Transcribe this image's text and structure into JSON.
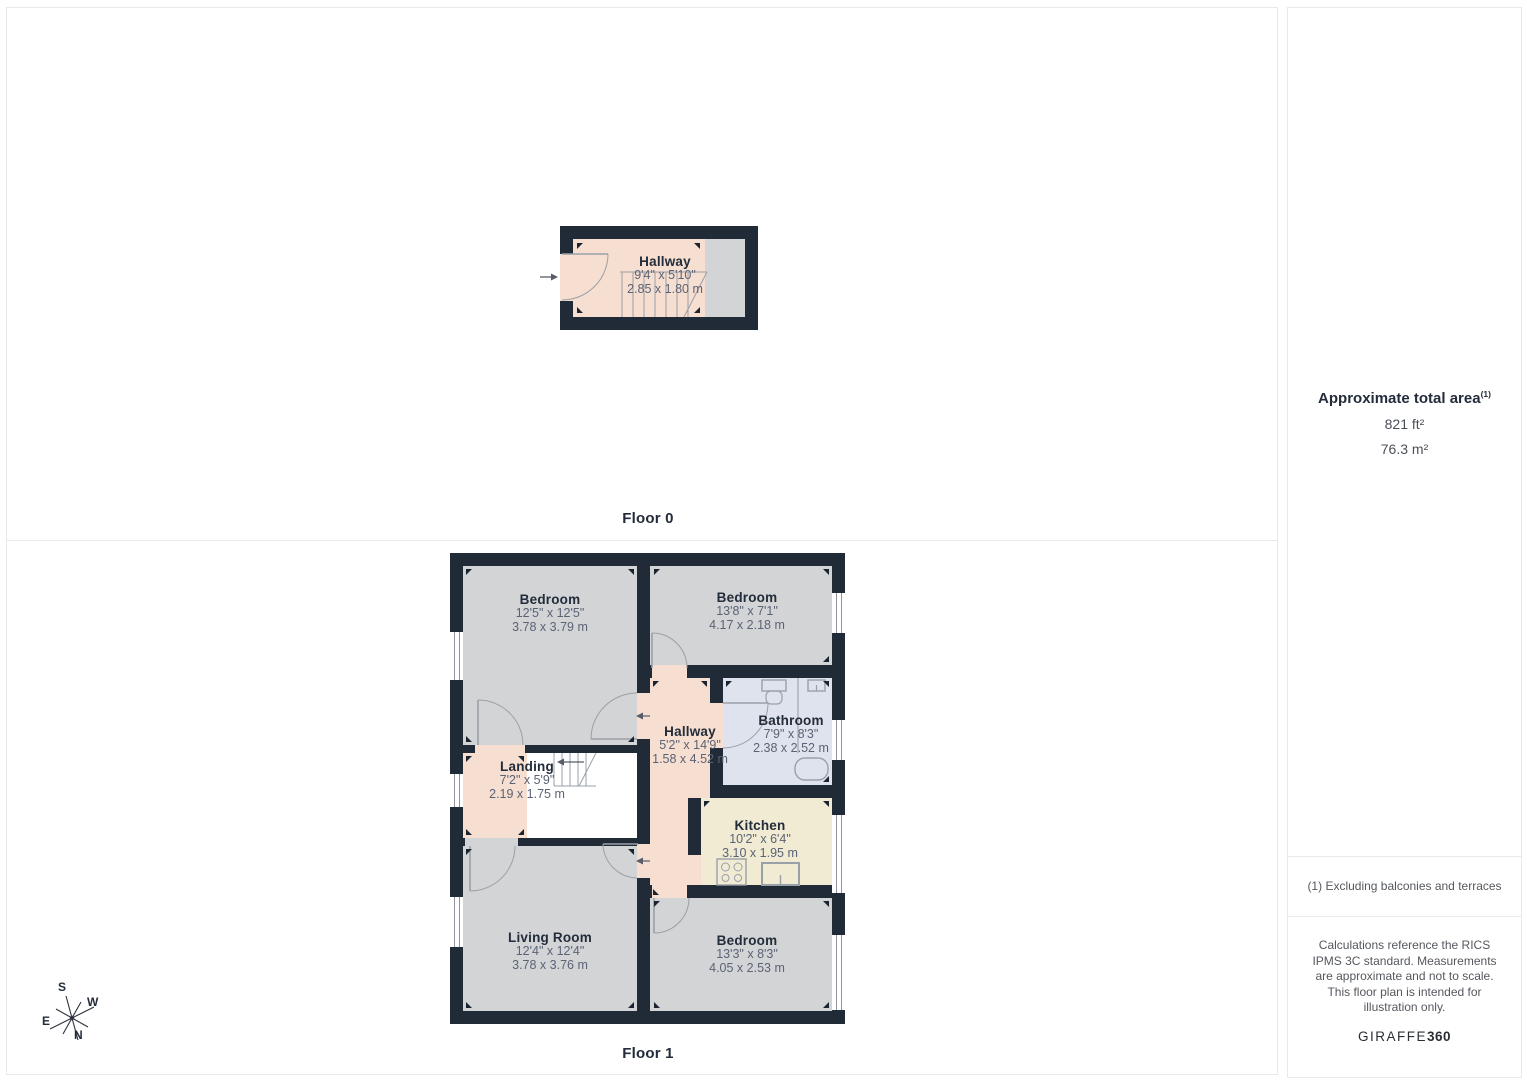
{
  "floors": [
    {
      "label": "Floor 0",
      "rooms": [
        {
          "name": "Hallway",
          "imperial": "9'4\" x 5'10\"",
          "metric": "2.85 x 1.80 m"
        }
      ]
    },
    {
      "label": "Floor 1",
      "rooms": [
        {
          "name": "Bedroom",
          "imperial": "12'5\" x 12'5\"",
          "metric": "3.78 x 3.79 m"
        },
        {
          "name": "Bedroom",
          "imperial": "13'8\" x 7'1\"",
          "metric": "4.17 x 2.18 m"
        },
        {
          "name": "Hallway",
          "imperial": "5'2\" x 14'9\"",
          "metric": "1.58 x 4.52 m"
        },
        {
          "name": "Bathroom",
          "imperial": "7'9\" x 8'3\"",
          "metric": "2.38 x 2.52 m"
        },
        {
          "name": "Landing",
          "imperial": "7'2\" x 5'9\"",
          "metric": "2.19 x 1.75 m"
        },
        {
          "name": "Kitchen",
          "imperial": "10'2\" x 6'4\"",
          "metric": "3.10 x 1.95 m"
        },
        {
          "name": "Living Room",
          "imperial": "12'4\" x 12'4\"",
          "metric": "3.78 x 3.76 m"
        },
        {
          "name": "Bedroom",
          "imperial": "13'3\" x 8'3\"",
          "metric": "4.05 x 2.53 m"
        }
      ]
    }
  ],
  "sidebar": {
    "area_title": "Approximate total area",
    "area_title_note": "(1)",
    "area_imperial": "821 ft²",
    "area_metric": "76.3 m²",
    "footnote": "(1) Excluding balconies and terraces",
    "disclaimer": "Calculations reference the RICS IPMS 3C standard. Measurements are approximate and not to scale. This floor plan is intended for illustration only.",
    "brand_regular": "GIRAFFE",
    "brand_bold": "360"
  },
  "compass": {
    "n": "N",
    "s": "S",
    "e": "E",
    "w": "W"
  },
  "colors": {
    "wall": "#212b38",
    "room_gray": "#d3d4d6",
    "room_peach": "#f6ded1",
    "room_blue": "#dfe3ed",
    "room_cream": "#f1ebd4",
    "stroke_gray": "#9aa0a8",
    "divider": "#e9e9e9"
  }
}
